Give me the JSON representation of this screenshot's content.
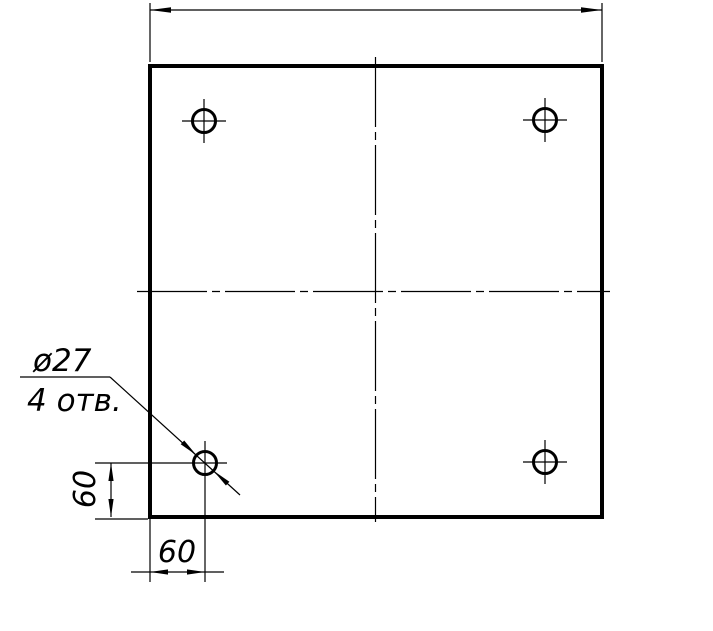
{
  "drawing": {
    "callout": {
      "diameter": "ø27",
      "holes_count": "4 отв."
    },
    "dimensions": {
      "hole_offset_left": "60",
      "hole_offset_bottom": "60"
    },
    "colors": {
      "ink": "#000000",
      "paper": "#ffffff"
    }
  }
}
